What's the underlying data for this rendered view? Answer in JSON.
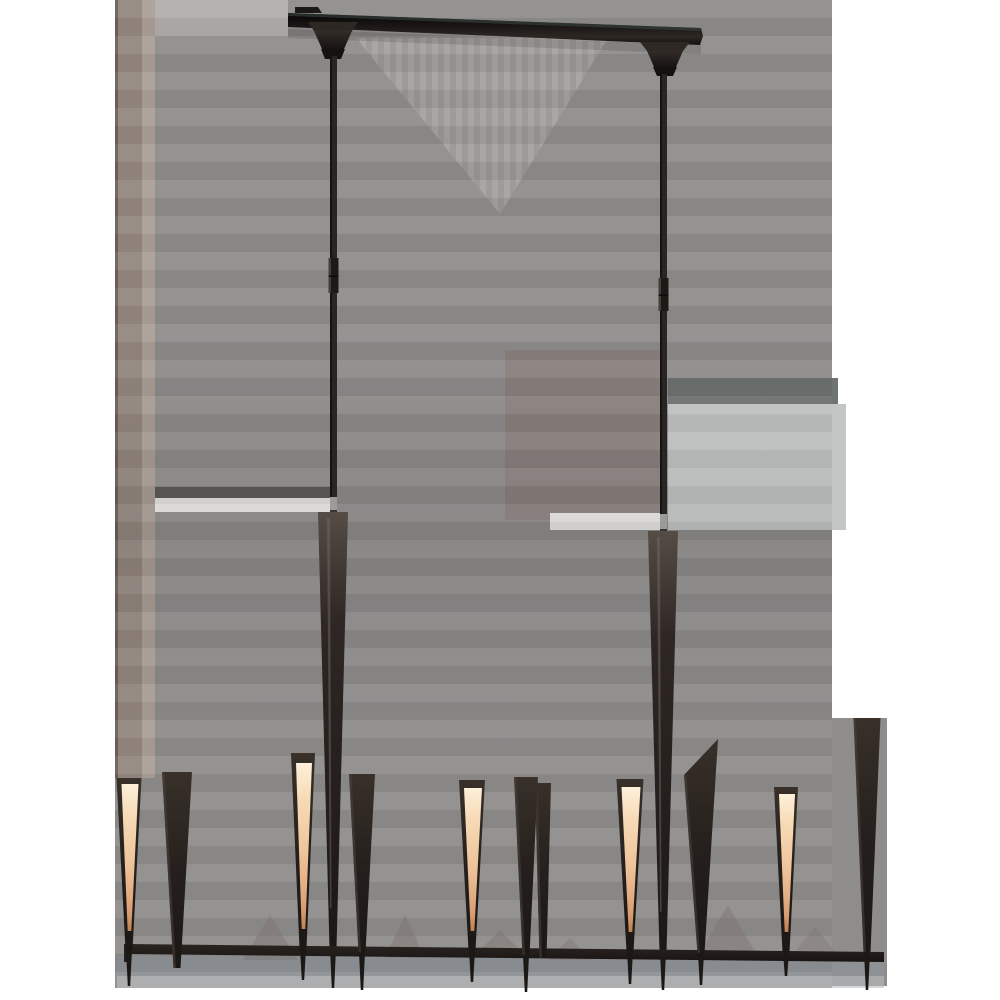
{
  "meta": {
    "alt": "Bronze black linear LED chandelier with tapered spike arms, five lit warm glow strips, two downrods and an angled ceiling canopy bar",
    "canvas": {
      "w": 1000,
      "h": 1000
    },
    "page_background": "#ffffff"
  },
  "palette": {
    "bg_base": "#8f8d8c",
    "bg_light_top": "#b2aeab",
    "bg_brown_dark": "#6e6159",
    "bg_brown": "#94887f",
    "bg_brown_light": "#ab9f96",
    "bg_stripe_a": "#a8a4a1",
    "bg_stripe_b": "#9c9896",
    "bg_dark_band": "#5f5d5b",
    "bg_white_band": "#e9e7e4",
    "bg_cool_light": "#c3c6c4",
    "bg_cool_dark": "#6f7472",
    "bg_mauve": "#8b817e",
    "bg_blue_band": "#8d9499",
    "bg_blue_light": "#b9bec2",
    "shadow_tri": "#7a716c",
    "metal_black": "#1c1816",
    "metal_dark": "#26211f",
    "metal_mid": "#383029",
    "rod": "#2a2422",
    "rod_edge": "#151211",
    "coupler": "#1d1917",
    "coupler_hl": "#463d37",
    "collar_silver": "#9b9b99",
    "cone_edge_hl": "#4a423c",
    "spike_hl": "#6f675f",
    "bar_teal": "#3c4a46",
    "glow_bright": "#fdf0da",
    "glow_warm": "#f2c9a0",
    "glow_deep": "#c08252"
  },
  "background": {
    "rects": [
      {
        "x": 115,
        "y": 0,
        "w": 717,
        "h": 988,
        "f": "bg_base"
      },
      {
        "x": 830,
        "y": 718,
        "w": 57,
        "h": 268,
        "f": "bg_base"
      },
      {
        "x": 115,
        "y": 0,
        "w": 173,
        "h": 36,
        "f": "bg_light_top"
      },
      {
        "x": 115,
        "y": 0,
        "w": 3,
        "h": 778,
        "f": "bg_brown_dark"
      },
      {
        "x": 118,
        "y": 0,
        "w": 24,
        "h": 778,
        "f": "bg_brown"
      },
      {
        "x": 142,
        "y": 0,
        "w": 13,
        "h": 778,
        "f": "bg_brown_light"
      },
      {
        "x": 668,
        "y": 378,
        "w": 170,
        "h": 26,
        "f": "bg_cool_dark"
      },
      {
        "x": 668,
        "y": 404,
        "w": 178,
        "h": 126,
        "f": "bg_cool_light"
      },
      {
        "x": 505,
        "y": 350,
        "w": 155,
        "h": 170,
        "f": "bg_mauve",
        "o": 0.9
      },
      {
        "x": 155,
        "y": 487,
        "w": 176,
        "h": 11,
        "f": "bg_dark_band"
      },
      {
        "x": 155,
        "y": 498,
        "w": 176,
        "h": 14,
        "f": "bg_white_band"
      },
      {
        "x": 550,
        "y": 513,
        "w": 110,
        "h": 17,
        "f": "bg_white_band"
      },
      {
        "x": 117,
        "y": 956,
        "w": 767,
        "h": 20,
        "f": "bg_blue_band",
        "o": 0.65
      },
      {
        "x": 117,
        "y": 976,
        "w": 767,
        "h": 12,
        "f": "bg_blue_light",
        "o": 0.6
      }
    ],
    "vee": {
      "points": "356,38 608,38 500,214"
    },
    "shadows": [
      {
        "points": "243,960 270,915 298,960",
        "o": 0.4
      },
      {
        "points": "385,958 405,915 425,958",
        "o": 0.4
      },
      {
        "points": "478,952 500,930 522,952",
        "o": 0.4
      },
      {
        "points": "548,960 570,938 592,960",
        "o": 0.35
      },
      {
        "points": "695,960 728,905 760,960",
        "o": 0.4
      },
      {
        "points": "792,955 815,927 838,955",
        "o": 0.3
      }
    ]
  },
  "canopy": {
    "bar": {
      "points": "288,13 701,28 703,36 700,45 288,27"
    },
    "bar_tab": {
      "points": "295,7 318,7 322,13 295,13"
    },
    "top_edge": {
      "points": "288,13 701,28 701,31 288,16"
    },
    "under_shadow": {
      "points": "288,29 701,45 701,54 288,38"
    },
    "cups": [
      {
        "lip": "308,22 358,22 352,31 314,31",
        "body": "314,31 352,31 344,49 322,49",
        "knob": "321,49 345,49 341,59 325,59"
      },
      {
        "lip": "640,42 690,42 683,51 647,51",
        "body": "647,51 683,51 676,67 654,67",
        "knob": "653,67 677,67 673,76 657,76"
      }
    ]
  },
  "rods": [
    {
      "cx": 333.5,
      "w": 7,
      "top": 56,
      "bottom": 516,
      "coupler": {
        "top": 258,
        "bottom": 293,
        "w": 10
      },
      "collar": {
        "top": 497,
        "bottom": 512
      }
    },
    {
      "cx": 663.5,
      "w": 7,
      "top": 74,
      "bottom": 535,
      "coupler": {
        "top": 278,
        "bottom": 311,
        "w": 10
      },
      "collar": {
        "top": 514,
        "bottom": 531
      }
    }
  ],
  "spikes": [
    {
      "cx": 333,
      "top": 512,
      "topW": 30,
      "tip": 948,
      "stub": 988
    },
    {
      "cx": 663,
      "top": 531,
      "topW": 30,
      "tip": 952,
      "stub": 990
    }
  ],
  "rail": {
    "points": "124,944 884,952 884,962 124,954",
    "endcap": "124,944 131,944 131,962 124,962"
  },
  "cones": [
    {
      "cx": 129,
      "topY": 778,
      "topW": 25,
      "tip": 950,
      "glow": true,
      "glowTop": 784,
      "glowBot": 931,
      "stub": 986
    },
    {
      "cx": 177,
      "topY": 772,
      "topW": 30,
      "tip": 968,
      "glow": false,
      "stub": 0
    },
    {
      "cx": 303,
      "topY": 753,
      "topW": 24,
      "tip": 948,
      "glow": true,
      "glowTop": 763,
      "glowBot": 929,
      "stub": 980
    },
    {
      "cx": 362,
      "topY": 774,
      "topW": 26,
      "tip": 952,
      "glow": false,
      "stub": 990
    },
    {
      "cx": 472,
      "topY": 780,
      "topW": 26,
      "tip": 950,
      "glow": true,
      "glowTop": 788,
      "glowBot": 931,
      "stub": 982
    },
    {
      "cx": 543,
      "topY": 783,
      "topW": 16,
      "tip": 958,
      "glow": false,
      "stub": 0
    },
    {
      "cx": 526,
      "topY": 777,
      "topW": 24,
      "tip": 955,
      "glow": false,
      "stub": 992
    },
    {
      "cx": 630,
      "topY": 779,
      "topW": 27,
      "tip": 951,
      "glow": true,
      "glowTop": 787,
      "glowBot": 932,
      "stub": 984
    },
    {
      "cx": 701,
      "topY": 775,
      "topY2": 739,
      "topW": 34,
      "tip": 953,
      "glow": false,
      "stub": 985
    },
    {
      "cx": 786,
      "topY": 787,
      "topW": 24,
      "tip": 952,
      "glow": true,
      "glowTop": 794,
      "glowBot": 932,
      "stub": 976
    },
    {
      "cx": 867,
      "topY": 718,
      "topW": 27,
      "tip": 952,
      "glow": false,
      "stub": 990
    }
  ]
}
